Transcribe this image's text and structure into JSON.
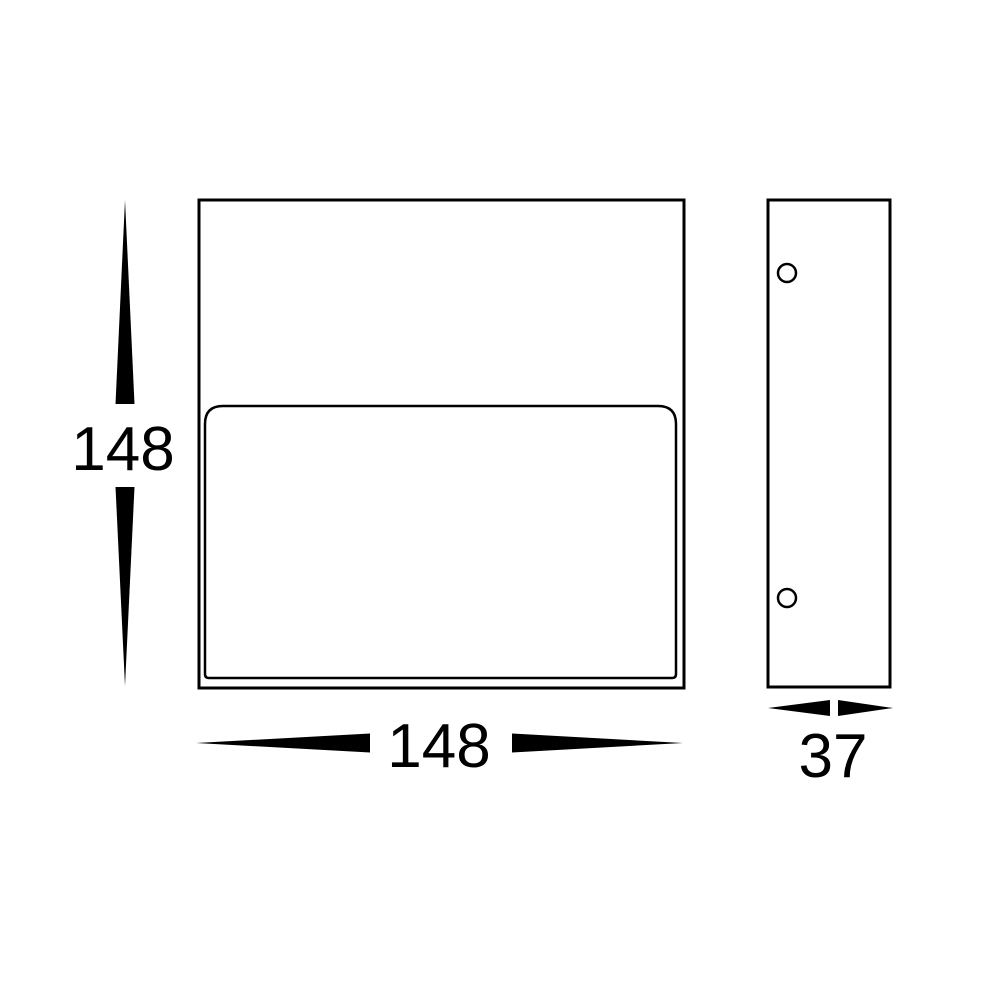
{
  "colors": {
    "line": "#000000",
    "background": "#ffffff"
  },
  "dimensions": {
    "height_label": "148",
    "width_label": "148",
    "depth_label": "37"
  }
}
